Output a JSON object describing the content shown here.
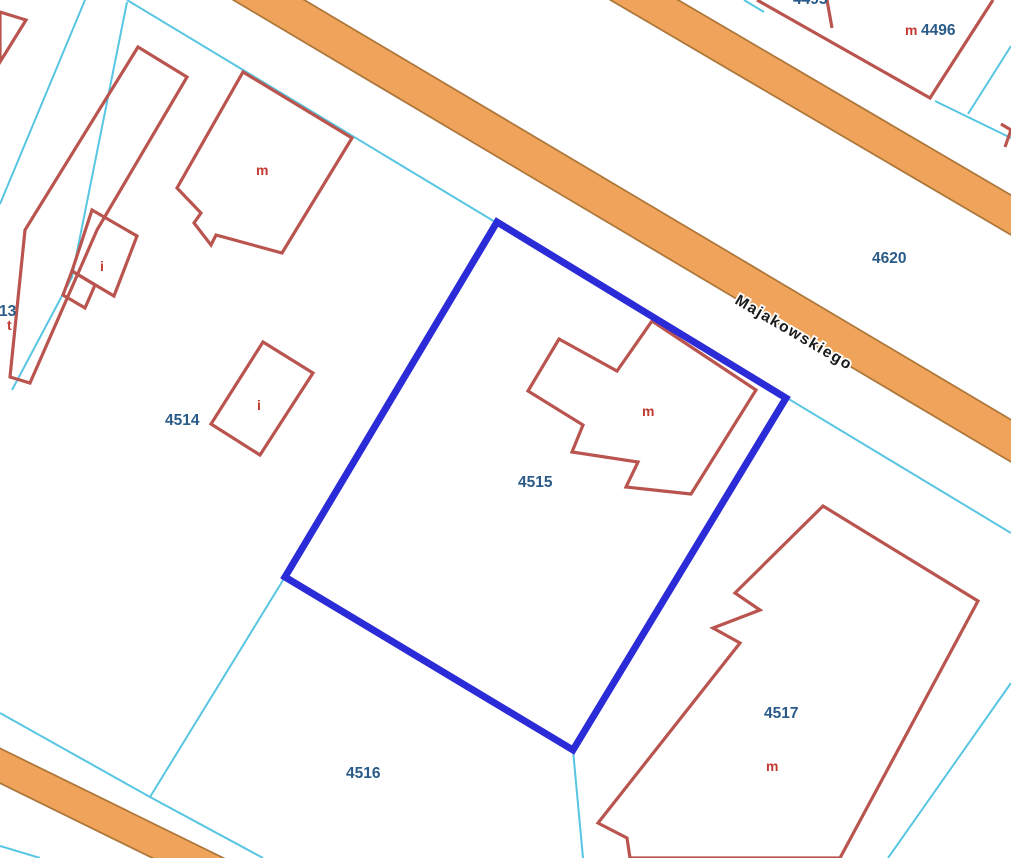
{
  "map": {
    "labels": {
      "street": "Majakowskiego",
      "p4513_partial": "13",
      "p4514": "4514",
      "p4515": "4515",
      "p4516": "4516",
      "p4517": "4517",
      "p4620": "4620",
      "p4496": "4496",
      "p_top_partial": "4495",
      "letter_t": "t",
      "letter_i_long_building": "i",
      "letter_i_small_building": "i",
      "letter_m_large_building": "m",
      "letter_m_selected_building": "m",
      "letter_m_south_building": "m",
      "letter_m_4496": "m"
    },
    "selected_parcel_id": "4515",
    "colors": {
      "parcel_boundary": "#58c6e2",
      "building_outline": "#b9544f",
      "selection": "#2b2bd8",
      "road_fill": "#f0a45b",
      "road_border": "#ad763a",
      "parcel_number_text": "#2a5a87",
      "building_letter_text": "#c13a31",
      "street_text": "#1a1a1a"
    }
  }
}
